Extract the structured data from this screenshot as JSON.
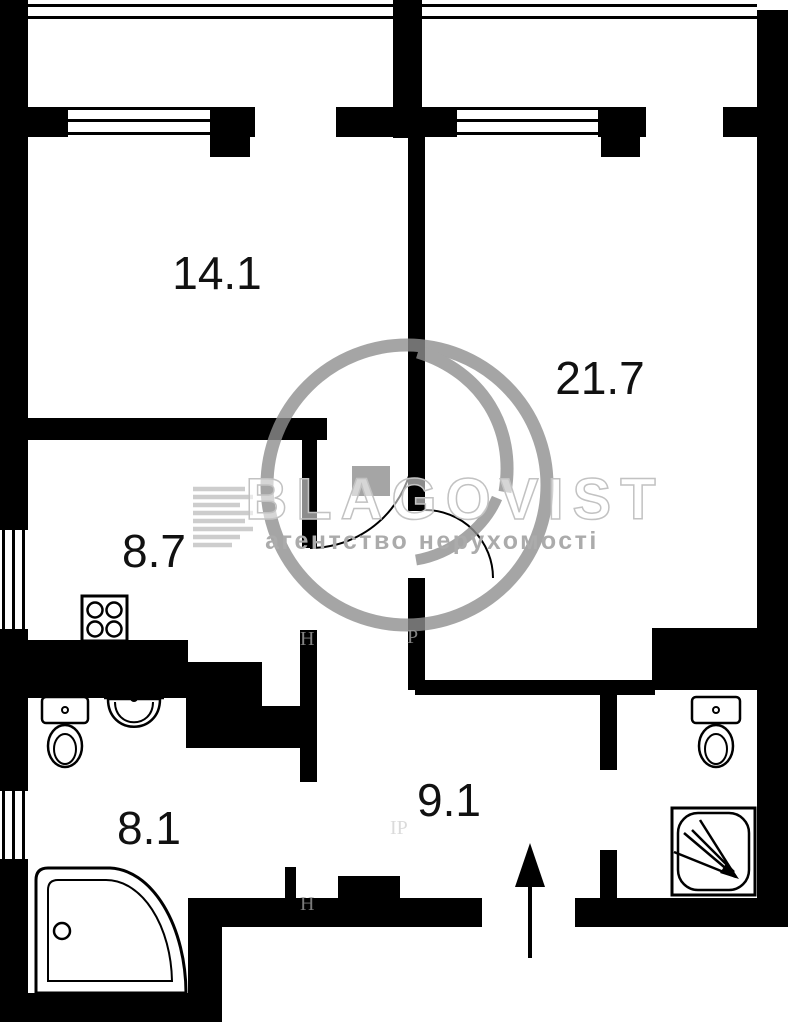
{
  "plan": {
    "rooms": [
      {
        "key": "room-14",
        "area": "14.1"
      },
      {
        "key": "room-21",
        "area": "21.7"
      },
      {
        "key": "kitchen",
        "area": "8.7"
      },
      {
        "key": "bathroom",
        "area": "8.1"
      },
      {
        "key": "hallway",
        "area": "9.1"
      }
    ],
    "watermark": {
      "brand": "BLAGOVIST",
      "tagline": "агентство нерухомості",
      "fragment_1": "Н",
      "fragment_2": "Р",
      "fragment_3": "Н",
      "fragment_4": "ІР"
    },
    "icons": [
      "stove-icon",
      "toilet-icon",
      "sink-icon",
      "corner-bathtub-icon",
      "shower-icon",
      "toilet-icon",
      "entrance-arrow-icon",
      "window-icon",
      "door-arc-icon"
    ],
    "colors": {
      "wall": "#000000",
      "background": "#ffffff",
      "watermark_logo": "#8f8f8f",
      "watermark_brand_stroke": "#c2c2c2",
      "watermark_tagline": "#ababab"
    }
  }
}
